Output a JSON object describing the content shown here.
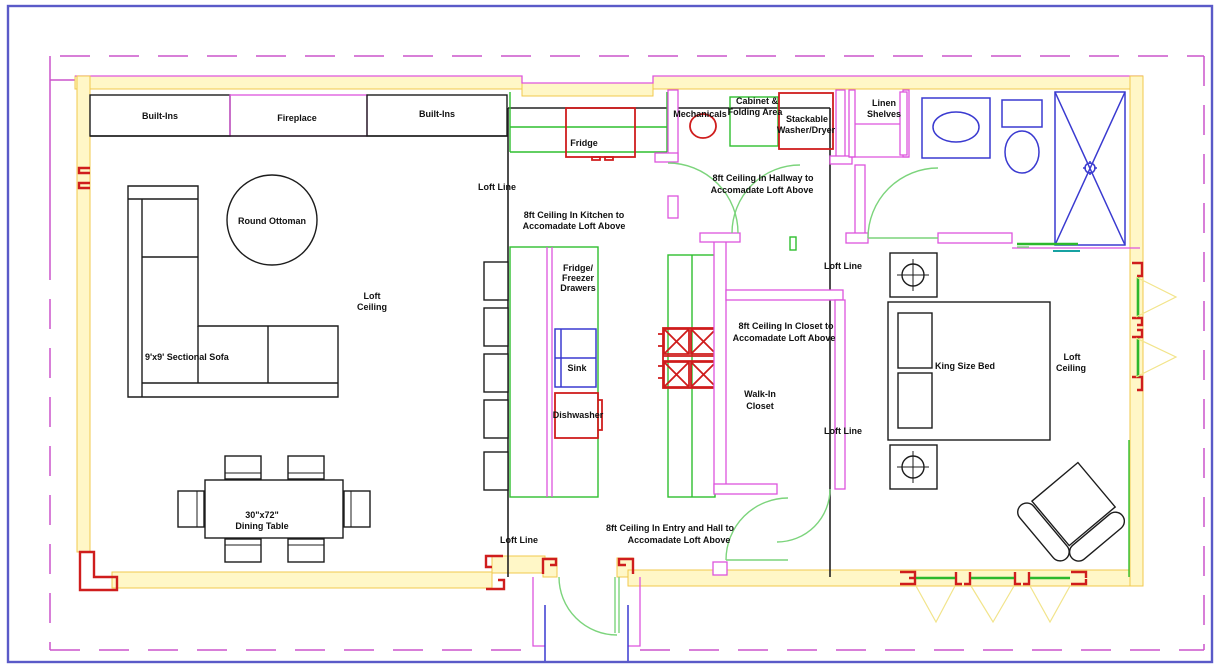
{
  "drawing": {
    "type": "residential floor plan with loft",
    "colors": {
      "boundary_blue": "#5a5ac8",
      "property_dash_magenta": "#cc55cc",
      "exterior_wall_yellow": "#f2c94c",
      "interior_wall_magenta": "#dd55dd",
      "door_green": "#7cd47c",
      "counter_green": "#2fbf2f",
      "appliance_red": "#cf1d1d",
      "fixture_blue": "#3a3ad0",
      "loft_line_black": "#222222"
    }
  },
  "labels": {
    "built_ins": "Built-Ins",
    "fireplace": "Fireplace",
    "round_ottoman": "Round Ottoman",
    "loft_line": "Loft Line",
    "loft_ceiling_l1": "Loft",
    "loft_ceiling_l2": "Ceiling",
    "sectional_sofa": "9'x9' Sectional Sofa",
    "dining_l1": "30\"x72\"",
    "dining_l2": "Dining Table",
    "fridge": "Fridge",
    "kitchen_ceiling_l1": "8ft Ceiling In Kitchen to",
    "kitchen_ceiling_l2": "Accomadate Loft Above",
    "fridge_freezer_l1": "Fridge/",
    "fridge_freezer_l2": "Freezer",
    "fridge_freezer_l3": "Drawers",
    "sink": "Sink",
    "dishwasher": "Dishwasher",
    "entry_ceiling_l1": "8ft Ceiling In Entry and Hall to",
    "entry_ceiling_l2": "Accomadate Loft Above",
    "mechanicals": "Mechanicals",
    "cabinet_l1": "Cabinet &",
    "cabinet_l2": "Folding Area",
    "washer_dryer_l1": "Stackable",
    "washer_dryer_l2": "Washer/Dryer",
    "linen_l1": "Linen",
    "linen_l2": "Shelves",
    "hallway_ceiling_l1": "8ft Ceiling In Hallway to",
    "hallway_ceiling_l2": "Accomadate Loft Above",
    "closet_ceiling_l1": "8ft Ceiling In Closet to",
    "closet_ceiling_l2": "Accomadate Loft Above",
    "walkin_l1": "Walk-In",
    "walkin_l2": "Closet",
    "king_bed": "King Size Bed"
  }
}
